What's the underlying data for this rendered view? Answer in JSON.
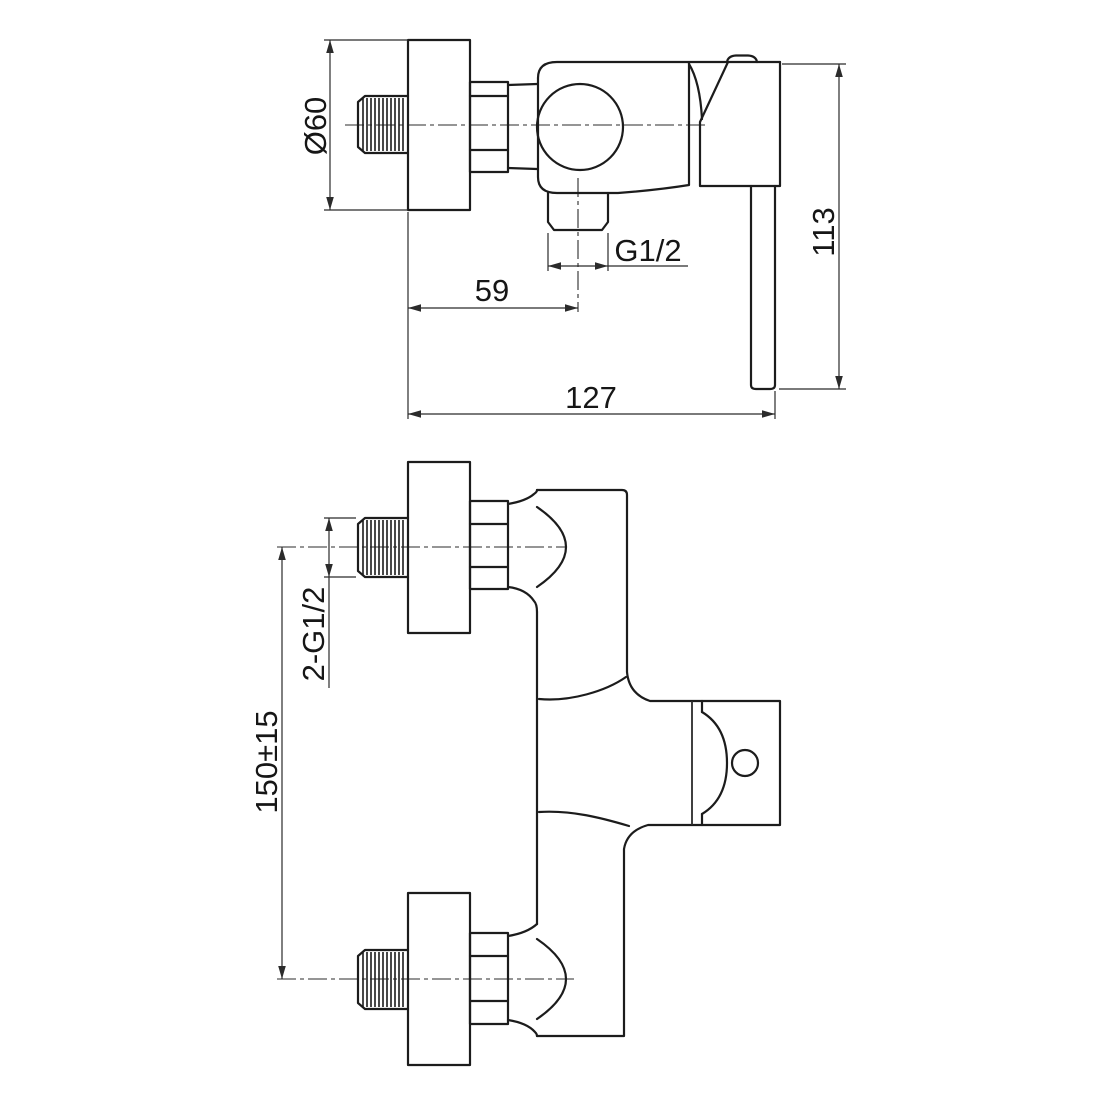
{
  "drawing": {
    "kind": "technical dimension drawing - shower mixer faucet",
    "background_color": "#ffffff",
    "line_color": "#1c1c1c",
    "dim_line_color": "#2b2b2b",
    "views": {
      "side_view": {
        "name": "side view (top)",
        "dimensions": {
          "flange_diameter": "Ø60",
          "outlet_offset": "59",
          "outlet_thread": "G1/2",
          "overall_width": "127",
          "overall_height": "113"
        }
      },
      "front_view": {
        "name": "front view (bottom)",
        "dimensions": {
          "inlet_threads": "2-G1/2",
          "inlet_spacing": "150±15"
        }
      }
    }
  }
}
